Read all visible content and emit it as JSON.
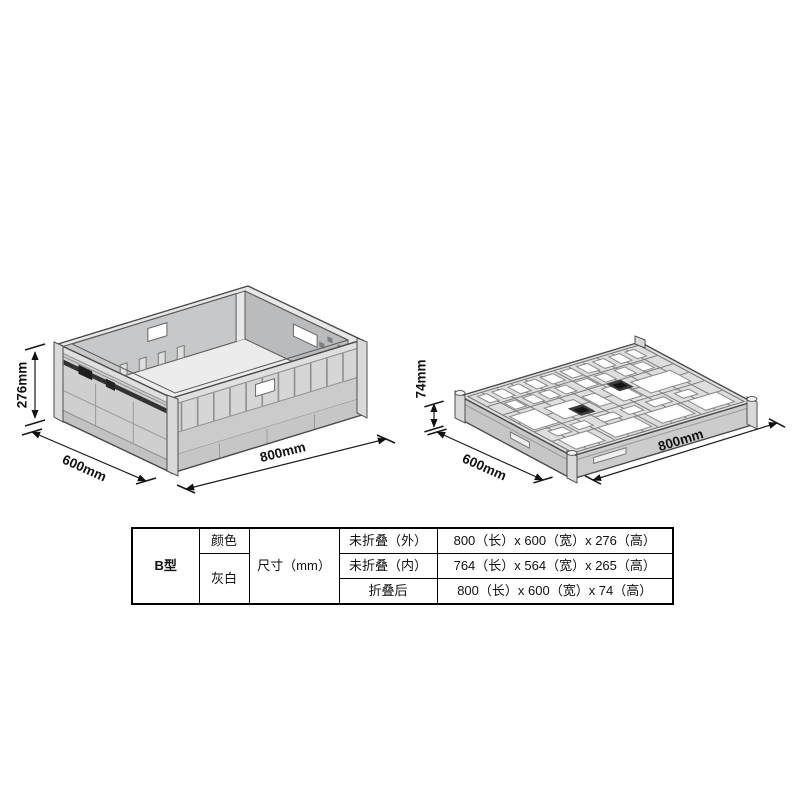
{
  "unfolded_view": {
    "height_label": "276mm",
    "width_label": "600mm",
    "length_label": "800mm"
  },
  "folded_view": {
    "height_label": "74mm",
    "width_label": "600mm",
    "length_label": "800mm"
  },
  "spec_table": {
    "model": "B型",
    "color_header": "颜色",
    "color_value": "灰白",
    "dimension_header": "尺寸（mm）",
    "rows": [
      {
        "state": "未折叠（外）",
        "dimensions": "800（长）x 600（宽）x 276（高）"
      },
      {
        "state": "未折叠（内）",
        "dimensions": "764（长）x 564（宽）x 265（高）"
      },
      {
        "state": "折叠后",
        "dimensions": "800（长）x 600（宽）x 74（高）"
      }
    ]
  },
  "colors": {
    "crate_body": "#cfcfcf",
    "crate_rim": "#e8e8e8",
    "outline": "#4a4a4a",
    "latch_dark": "#2f2f2f",
    "table_border": "#000000"
  }
}
